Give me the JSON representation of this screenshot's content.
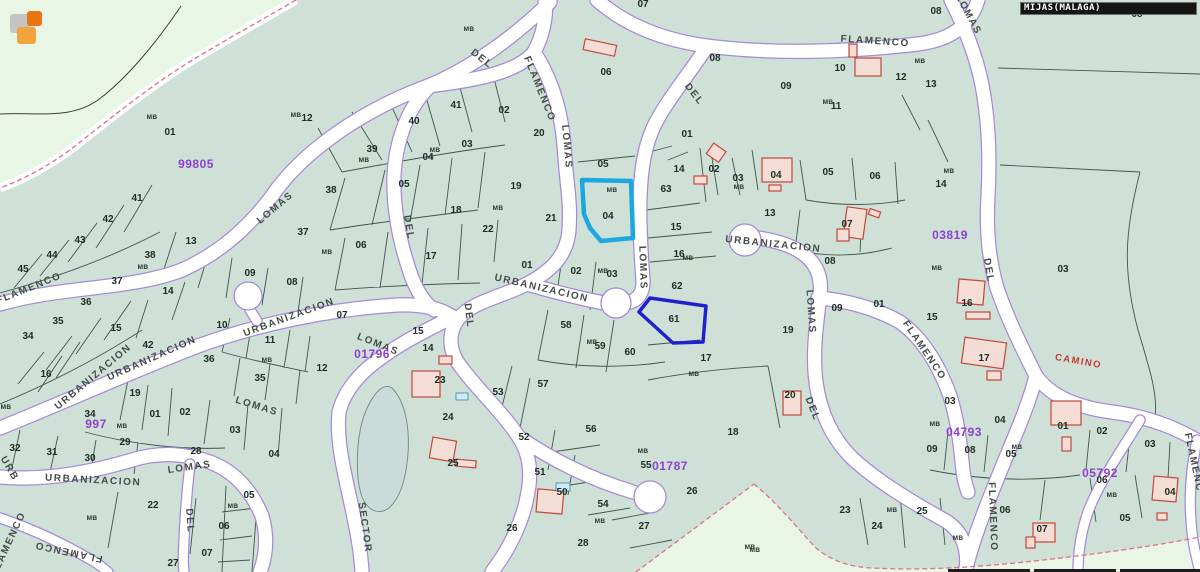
{
  "header": {
    "municipality_label": "MIJAS(MALAGA)"
  },
  "map": {
    "colors": {
      "parcel_area": "#cfe1d7",
      "outside_area": "#e9f6e6",
      "road_fill": "#ffffff",
      "road_edge": "#a58ad8",
      "parcel_line": "#374e41",
      "building_outline": "#c2473a",
      "building_fill": "#f3ddd5",
      "zone_boundary_pink": "#e0708a",
      "zone_code_purple": "#8d3fd1",
      "pond": "#c9dcda",
      "camino_red": "#c43b30"
    },
    "highlight_parcels": [
      {
        "number": "04",
        "color": "#1ba8e0"
      },
      {
        "number": "61",
        "color": "#2020cf"
      }
    ],
    "camino_label": {
      "text": "CAMINO",
      "x": 1078,
      "y": 364,
      "rot": 10
    },
    "zone_codes": [
      {
        "text": "99805",
        "x": 196,
        "y": 168
      },
      {
        "text": "01796",
        "x": 372,
        "y": 358
      },
      {
        "text": "03819",
        "x": 950,
        "y": 239
      },
      {
        "text": "01787",
        "x": 670,
        "y": 470
      },
      {
        "text": "04793",
        "x": 964,
        "y": 436
      },
      {
        "text": "05792",
        "x": 1100,
        "y": 477
      },
      {
        "text": "997",
        "x": 96,
        "y": 428
      }
    ],
    "street_labels": [
      {
        "text": "FLAMENCO",
        "x": 875,
        "y": 44,
        "rot": 4
      },
      {
        "text": "LOMAS",
        "x": 966,
        "y": 16,
        "rot": 62
      },
      {
        "text": "DEL",
        "x": 480,
        "y": 61,
        "rot": 38
      },
      {
        "text": "FLAMENCO",
        "x": 537,
        "y": 90,
        "rot": 68
      },
      {
        "text": "LOMAS",
        "x": 564,
        "y": 147,
        "rot": 85
      },
      {
        "text": "DEL",
        "x": 692,
        "y": 96,
        "rot": 52
      },
      {
        "text": "LOMAS",
        "x": 640,
        "y": 268,
        "rot": 88
      },
      {
        "text": "DEL",
        "x": 406,
        "y": 228,
        "rot": 80
      },
      {
        "text": "DEL",
        "x": 466,
        "y": 316,
        "rot": 83
      },
      {
        "text": "LOMAS",
        "x": 277,
        "y": 210,
        "rot": -40
      },
      {
        "text": "FLAMENCO",
        "x": 30,
        "y": 291,
        "rot": -22
      },
      {
        "text": "URBANIZACION",
        "x": 95,
        "y": 379,
        "rot": -40
      },
      {
        "text": "URBANIZACION",
        "x": 153,
        "y": 361,
        "rot": -24
      },
      {
        "text": "URBANIZACION",
        "x": 290,
        "y": 320,
        "rot": -20
      },
      {
        "text": "URBANIZACION",
        "x": 541,
        "y": 291,
        "rot": 13
      },
      {
        "text": "URBANIZACION",
        "x": 773,
        "y": 247,
        "rot": 6
      },
      {
        "text": "URBANIZACION",
        "x": 93,
        "y": 483,
        "rot": 3
      },
      {
        "text": "LOMAS",
        "x": 190,
        "y": 470,
        "rot": -8
      },
      {
        "text": "LOMAS",
        "x": 256,
        "y": 409,
        "rot": 17
      },
      {
        "text": "LOMAS",
        "x": 377,
        "y": 347,
        "rot": 22
      },
      {
        "text": "DEL",
        "x": 187,
        "y": 521,
        "rot": 86
      },
      {
        "text": "FLAMENCO",
        "x": 69,
        "y": 549,
        "rot": 192
      },
      {
        "text": "FLAMENCO",
        "x": 11,
        "y": 545,
        "rot": -65
      },
      {
        "text": "SECTOR",
        "x": 362,
        "y": 528,
        "rot": 82
      },
      {
        "text": "LOMAS",
        "x": 808,
        "y": 312,
        "rot": 86
      },
      {
        "text": "DEL",
        "x": 810,
        "y": 410,
        "rot": 68
      },
      {
        "text": "DEL",
        "x": 986,
        "y": 271,
        "rot": 80
      },
      {
        "text": "FLAMENCO",
        "x": 922,
        "y": 352,
        "rot": 56
      },
      {
        "text": "FLAMENCO",
        "x": 990,
        "y": 517,
        "rot": 88
      },
      {
        "text": "FLAMENC",
        "x": 1191,
        "y": 463,
        "rot": 78
      },
      {
        "text": "URB",
        "x": 7,
        "y": 470,
        "rot": 60
      }
    ],
    "mb_label_text": "MB",
    "mb_positions": [
      [
        152,
        119
      ],
      [
        143,
        269
      ],
      [
        92,
        520
      ],
      [
        233,
        508
      ],
      [
        296,
        117
      ],
      [
        364,
        162
      ],
      [
        435,
        152
      ],
      [
        327,
        254
      ],
      [
        498,
        210
      ],
      [
        267,
        362
      ],
      [
        612,
        192
      ],
      [
        603,
        273
      ],
      [
        688,
        260
      ],
      [
        592,
        344
      ],
      [
        694,
        376
      ],
      [
        739,
        189
      ],
      [
        828,
        104
      ],
      [
        949,
        173
      ],
      [
        920,
        63
      ],
      [
        937,
        270
      ],
      [
        935,
        426
      ],
      [
        1017,
        449
      ],
      [
        1112,
        497
      ],
      [
        750,
        549
      ],
      [
        892,
        512
      ],
      [
        958,
        540
      ],
      [
        755,
        552
      ],
      [
        643,
        453
      ],
      [
        600,
        523
      ],
      [
        122,
        428
      ],
      [
        6,
        409
      ],
      [
        469,
        31
      ]
    ],
    "parcel_numbers": [
      {
        "t": "01",
        "x": 170,
        "y": 135
      },
      {
        "t": "41",
        "x": 137,
        "y": 201
      },
      {
        "t": "42",
        "x": 108,
        "y": 222
      },
      {
        "t": "43",
        "x": 80,
        "y": 243
      },
      {
        "t": "44",
        "x": 52,
        "y": 258
      },
      {
        "t": "45",
        "x": 23,
        "y": 272
      },
      {
        "t": "13",
        "x": 191,
        "y": 244
      },
      {
        "t": "38",
        "x": 150,
        "y": 258
      },
      {
        "t": "37",
        "x": 117,
        "y": 284
      },
      {
        "t": "36",
        "x": 86,
        "y": 305
      },
      {
        "t": "35",
        "x": 58,
        "y": 324
      },
      {
        "t": "34",
        "x": 28,
        "y": 339
      },
      {
        "t": "14",
        "x": 168,
        "y": 294
      },
      {
        "t": "15",
        "x": 116,
        "y": 331
      },
      {
        "t": "42",
        "x": 148,
        "y": 348
      },
      {
        "t": "16",
        "x": 46,
        "y": 377
      },
      {
        "t": "36",
        "x": 209,
        "y": 362
      },
      {
        "t": "19",
        "x": 135,
        "y": 396
      },
      {
        "t": "34",
        "x": 90,
        "y": 417
      },
      {
        "t": "01",
        "x": 155,
        "y": 417
      },
      {
        "t": "02",
        "x": 185,
        "y": 415
      },
      {
        "t": "29",
        "x": 125,
        "y": 445
      },
      {
        "t": "32",
        "x": 15,
        "y": 451
      },
      {
        "t": "31",
        "x": 52,
        "y": 455
      },
      {
        "t": "30",
        "x": 90,
        "y": 461
      },
      {
        "t": "28",
        "x": 196,
        "y": 454
      },
      {
        "t": "03",
        "x": 235,
        "y": 433
      },
      {
        "t": "04",
        "x": 274,
        "y": 457
      },
      {
        "t": "22",
        "x": 153,
        "y": 508
      },
      {
        "t": "05",
        "x": 249,
        "y": 498
      },
      {
        "t": "06",
        "x": 224,
        "y": 529
      },
      {
        "t": "07",
        "x": 207,
        "y": 556
      },
      {
        "t": "27",
        "x": 173,
        "y": 566
      },
      {
        "t": "10",
        "x": 222,
        "y": 328
      },
      {
        "t": "11",
        "x": 270,
        "y": 343
      },
      {
        "t": "07",
        "x": 342,
        "y": 318
      },
      {
        "t": "12",
        "x": 322,
        "y": 371
      },
      {
        "t": "35",
        "x": 260,
        "y": 381
      },
      {
        "t": "12",
        "x": 307,
        "y": 121
      },
      {
        "t": "40",
        "x": 414,
        "y": 124
      },
      {
        "t": "41",
        "x": 456,
        "y": 108
      },
      {
        "t": "02",
        "x": 504,
        "y": 113
      },
      {
        "t": "39",
        "x": 372,
        "y": 152
      },
      {
        "t": "03",
        "x": 467,
        "y": 147
      },
      {
        "t": "04",
        "x": 428,
        "y": 160
      },
      {
        "t": "05",
        "x": 404,
        "y": 187
      },
      {
        "t": "38",
        "x": 331,
        "y": 193
      },
      {
        "t": "19",
        "x": 516,
        "y": 189
      },
      {
        "t": "18",
        "x": 456,
        "y": 213
      },
      {
        "t": "22",
        "x": 488,
        "y": 232
      },
      {
        "t": "37",
        "x": 303,
        "y": 235
      },
      {
        "t": "06",
        "x": 361,
        "y": 248
      },
      {
        "t": "17",
        "x": 431,
        "y": 259
      },
      {
        "t": "08",
        "x": 292,
        "y": 285
      },
      {
        "t": "09",
        "x": 250,
        "y": 276
      },
      {
        "t": "07",
        "x": 643,
        "y": 7
      },
      {
        "t": "06",
        "x": 606,
        "y": 75
      },
      {
        "t": "08",
        "x": 715,
        "y": 61
      },
      {
        "t": "09",
        "x": 786,
        "y": 89
      },
      {
        "t": "10",
        "x": 840,
        "y": 71
      },
      {
        "t": "11",
        "x": 836,
        "y": 109
      },
      {
        "t": "01",
        "x": 687,
        "y": 137
      },
      {
        "t": "20",
        "x": 539,
        "y": 136
      },
      {
        "t": "08",
        "x": 936,
        "y": 14
      },
      {
        "t": "08",
        "x": 1137,
        "y": 17
      },
      {
        "t": "05",
        "x": 603,
        "y": 167
      },
      {
        "t": "04",
        "x": 608,
        "y": 219
      },
      {
        "t": "63",
        "x": 666,
        "y": 192
      },
      {
        "t": "14",
        "x": 679,
        "y": 172
      },
      {
        "t": "02",
        "x": 714,
        "y": 172
      },
      {
        "t": "03",
        "x": 738,
        "y": 181
      },
      {
        "t": "04",
        "x": 776,
        "y": 178
      },
      {
        "t": "05",
        "x": 828,
        "y": 175
      },
      {
        "t": "06",
        "x": 875,
        "y": 179
      },
      {
        "t": "07",
        "x": 847,
        "y": 227
      },
      {
        "t": "08",
        "x": 830,
        "y": 264
      },
      {
        "t": "09",
        "x": 837,
        "y": 311
      },
      {
        "t": "01",
        "x": 879,
        "y": 307
      },
      {
        "t": "13",
        "x": 770,
        "y": 216
      },
      {
        "t": "15",
        "x": 676,
        "y": 230
      },
      {
        "t": "21",
        "x": 551,
        "y": 221
      },
      {
        "t": "16",
        "x": 679,
        "y": 257
      },
      {
        "t": "62",
        "x": 677,
        "y": 289
      },
      {
        "t": "61",
        "x": 674,
        "y": 322
      },
      {
        "t": "02",
        "x": 576,
        "y": 274
      },
      {
        "t": "03",
        "x": 612,
        "y": 277
      },
      {
        "t": "01",
        "x": 527,
        "y": 268
      },
      {
        "t": "58",
        "x": 566,
        "y": 328
      },
      {
        "t": "59",
        "x": 600,
        "y": 349
      },
      {
        "t": "60",
        "x": 630,
        "y": 355
      },
      {
        "t": "17",
        "x": 706,
        "y": 361
      },
      {
        "t": "19",
        "x": 788,
        "y": 333
      },
      {
        "t": "20",
        "x": 790,
        "y": 398
      },
      {
        "t": "18",
        "x": 733,
        "y": 435
      },
      {
        "t": "57",
        "x": 543,
        "y": 387
      },
      {
        "t": "53",
        "x": 498,
        "y": 395
      },
      {
        "t": "15",
        "x": 418,
        "y": 334
      },
      {
        "t": "14",
        "x": 428,
        "y": 351
      },
      {
        "t": "23",
        "x": 440,
        "y": 383
      },
      {
        "t": "24",
        "x": 448,
        "y": 420
      },
      {
        "t": "25",
        "x": 453,
        "y": 466
      },
      {
        "t": "52",
        "x": 524,
        "y": 440
      },
      {
        "t": "51",
        "x": 540,
        "y": 475
      },
      {
        "t": "50",
        "x": 562,
        "y": 495
      },
      {
        "t": "56",
        "x": 591,
        "y": 432
      },
      {
        "t": "54",
        "x": 603,
        "y": 507
      },
      {
        "t": "55",
        "x": 646,
        "y": 468
      },
      {
        "t": "26",
        "x": 692,
        "y": 494
      },
      {
        "t": "27",
        "x": 644,
        "y": 529
      },
      {
        "t": "28",
        "x": 583,
        "y": 546
      },
      {
        "t": "26",
        "x": 512,
        "y": 531
      },
      {
        "t": "12",
        "x": 901,
        "y": 80
      },
      {
        "t": "13",
        "x": 931,
        "y": 87
      },
      {
        "t": "14",
        "x": 941,
        "y": 187
      },
      {
        "t": "03",
        "x": 1063,
        "y": 272
      },
      {
        "t": "16",
        "x": 967,
        "y": 306
      },
      {
        "t": "15",
        "x": 932,
        "y": 320
      },
      {
        "t": "17",
        "x": 984,
        "y": 361
      },
      {
        "t": "03",
        "x": 950,
        "y": 404
      },
      {
        "t": "04",
        "x": 1000,
        "y": 423
      },
      {
        "t": "09",
        "x": 932,
        "y": 452
      },
      {
        "t": "08",
        "x": 970,
        "y": 453
      },
      {
        "t": "05",
        "x": 1011,
        "y": 457
      },
      {
        "t": "01",
        "x": 1063,
        "y": 429
      },
      {
        "t": "02",
        "x": 1102,
        "y": 434
      },
      {
        "t": "03",
        "x": 1150,
        "y": 447
      },
      {
        "t": "06",
        "x": 1102,
        "y": 483
      },
      {
        "t": "04",
        "x": 1170,
        "y": 495
      },
      {
        "t": "05",
        "x": 1125,
        "y": 521
      },
      {
        "t": "06",
        "x": 1005,
        "y": 513
      },
      {
        "t": "07",
        "x": 1042,
        "y": 532
      },
      {
        "t": "23",
        "x": 845,
        "y": 513
      },
      {
        "t": "24",
        "x": 877,
        "y": 529
      },
      {
        "t": "25",
        "x": 922,
        "y": 514
      }
    ]
  },
  "logo": {
    "colors": {
      "gray": "#c4c4c4",
      "orange": "#e87511",
      "amber": "#f2a33c"
    }
  }
}
